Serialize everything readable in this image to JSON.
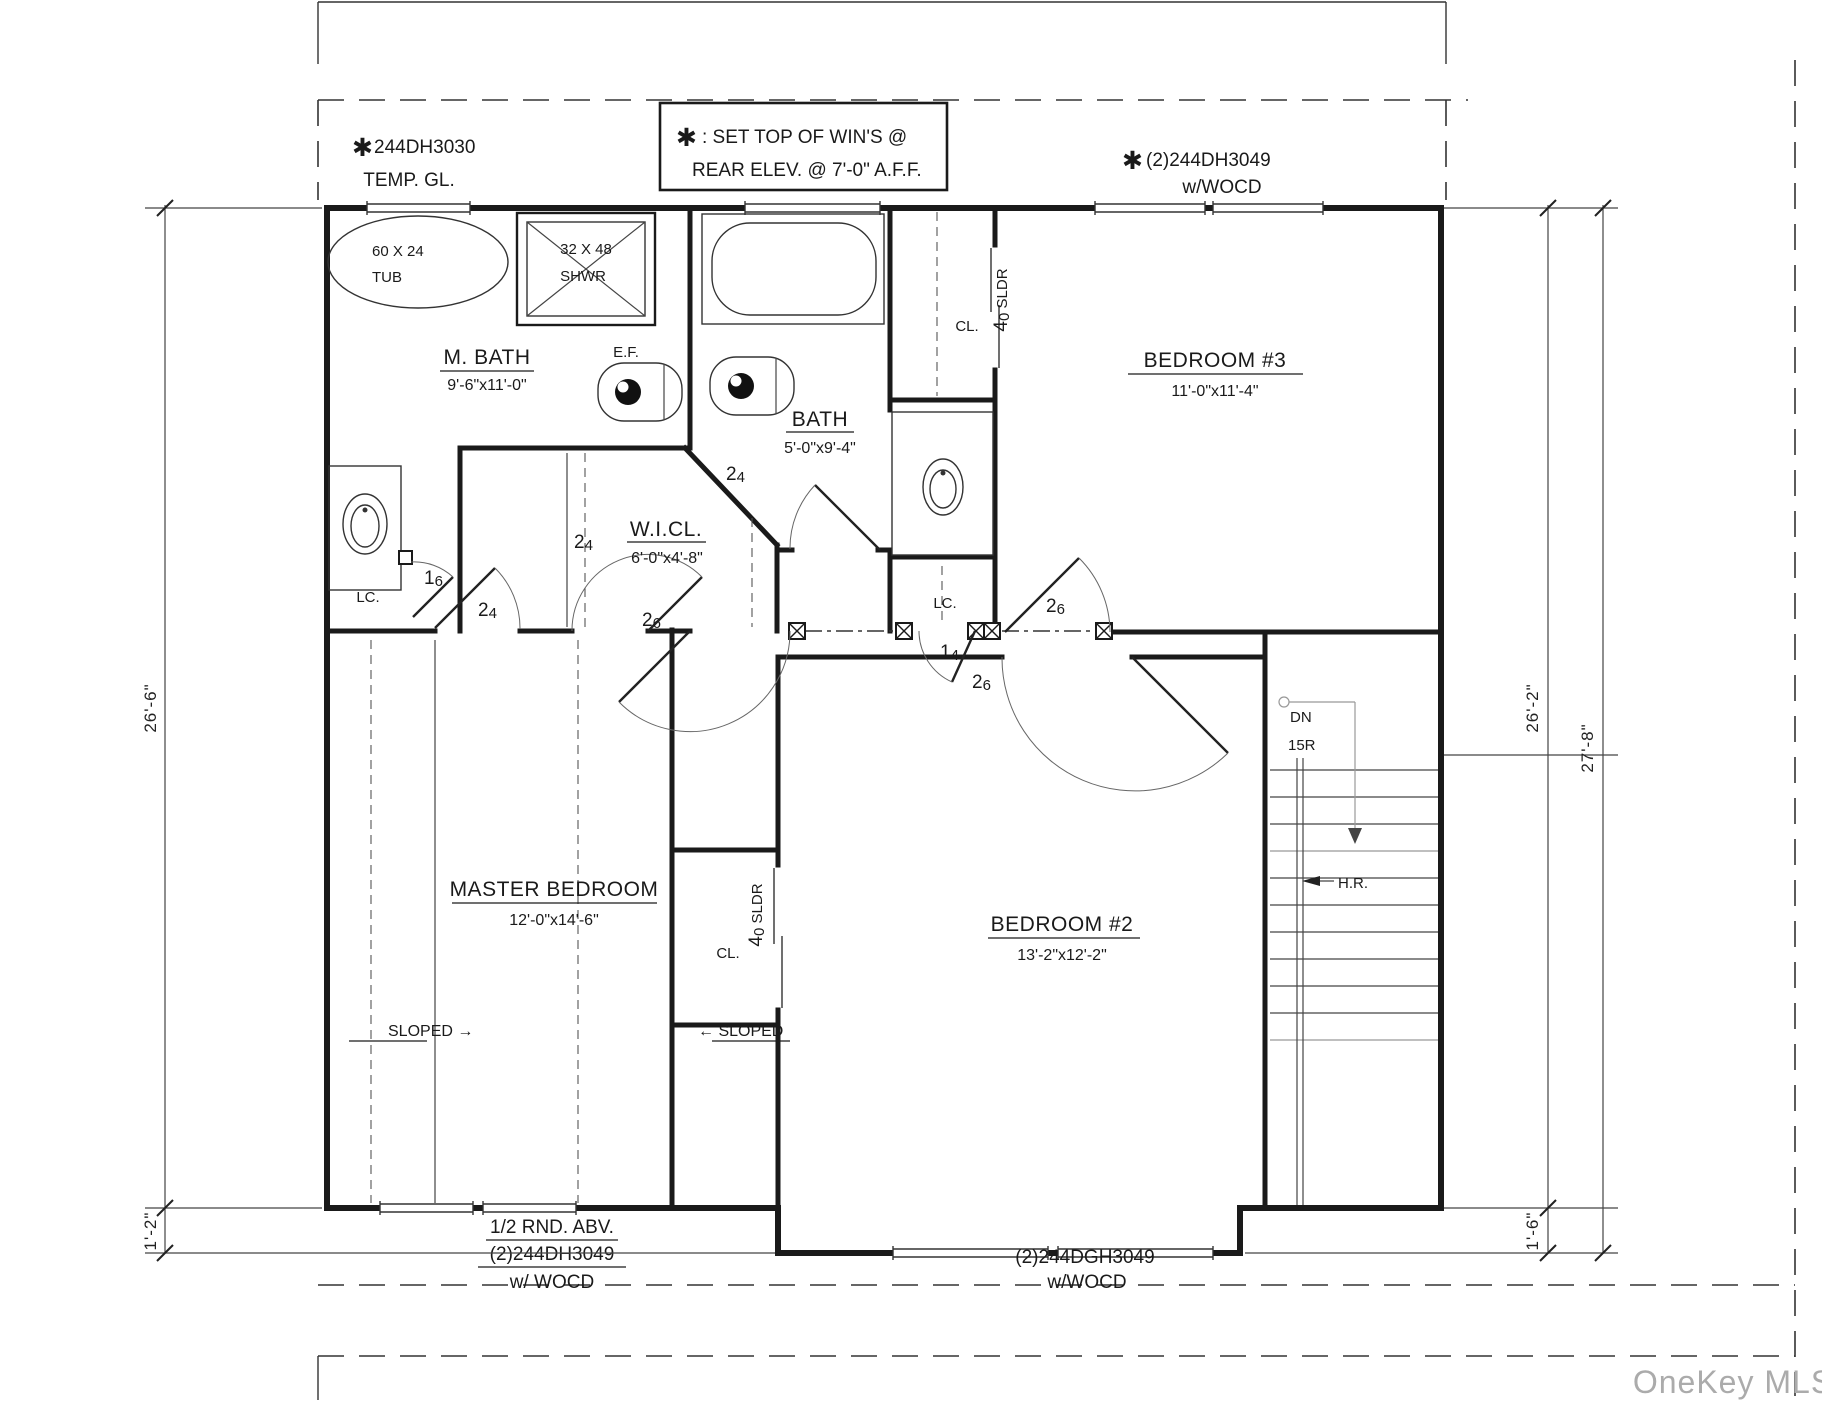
{
  "plan": {
    "notes": {
      "asterisk": "✱",
      "window_tl": {
        "line1": "244DH3030",
        "line2": "TEMP. GL."
      },
      "note_box": {
        "line1": ": SET TOP OF WIN'S @",
        "line2": "REAR ELEV. @ 7'-0\" A.F.F."
      },
      "window_tr": {
        "line1": "(2)244DH3049",
        "line2": "w/WOCD"
      },
      "window_bl": {
        "line1": "1/2 RND. ABV.",
        "line2": "(2)244DH3049",
        "line3": "w/ WOCD"
      },
      "window_br": {
        "line1": "(2)244DGH3049",
        "line2": "w/WOCD"
      }
    },
    "rooms": {
      "mbath": {
        "name": "M. BATH",
        "dims": "9'-6\"x11'-0\""
      },
      "bath": {
        "name": "BATH",
        "dims": "5'-0\"x9'-4\""
      },
      "wicl": {
        "name": "W.I.CL.",
        "dims": "6'-0\"x4'-8\""
      },
      "bedroom3": {
        "name": "BEDROOM #3",
        "dims": "11'-0\"x11'-4\""
      },
      "master": {
        "name": "MASTER BEDROOM",
        "dims": "12'-0\"x14'-6\""
      },
      "bedroom2": {
        "name": "BEDROOM #2",
        "dims": "13'-2\"x12'-2\""
      }
    },
    "fixtures": {
      "tub": {
        "line1": "60 X 24",
        "line2": "TUB"
      },
      "shower": {
        "line1": "32 X 48",
        "line2": "SHWR"
      },
      "exhaust_fan": "E.F."
    },
    "closets": {
      "linen": "LC.",
      "closet": "CL.",
      "slider_big": "4",
      "slider_small": "0",
      "slider_rest": " SLDR"
    },
    "doors": {
      "d24": {
        "big": "2",
        "small": "4"
      },
      "d26": {
        "big": "2",
        "small": "6"
      },
      "d16": {
        "big": "1",
        "small": "6"
      },
      "d14": {
        "big": "1",
        "small": "4"
      }
    },
    "stairs": {
      "dn": "DN",
      "risers": "15R",
      "handrail": "H.R."
    },
    "master_notes": {
      "sloped_left": "SLOPED →",
      "sloped_right": "← SLOPED"
    },
    "dimensions": {
      "left": "26'-6\"",
      "left_lower": "1'-2\"",
      "right_inner": "26'-2\"",
      "right_lower": "1'-6\"",
      "right_outer": "27'-8\""
    },
    "watermark": "OneKey MLS"
  }
}
